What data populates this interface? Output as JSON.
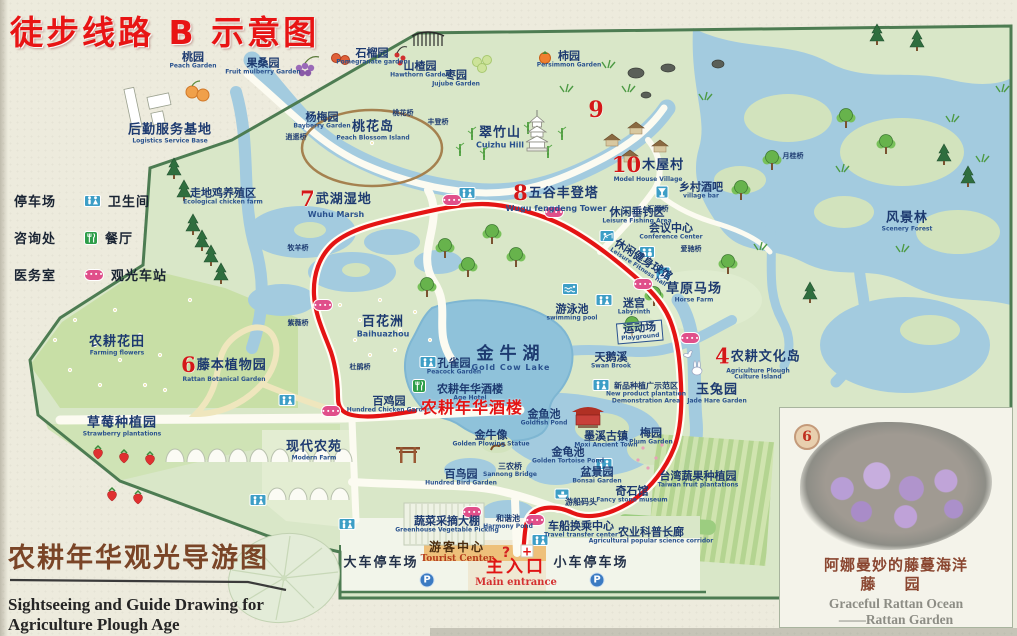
{
  "title": "徒步线路 B 示意图",
  "colors": {
    "route_red": "#e41414",
    "title_red": "#e81414",
    "water": "#a3cbdf",
    "land": "#d9e7c8",
    "label_blue": "#1d3a70",
    "badge_red": "#d41818",
    "footer_brown": "#7a4527",
    "toilet_icon": "#3d9ec6",
    "restaurant_icon": "#2e9e4a",
    "bus_station_icon": "#e04f8a"
  },
  "legend": {
    "left": [
      {
        "label": "停车场"
      },
      {
        "label": "咨询处"
      },
      {
        "label": "医务室"
      }
    ],
    "right": [
      {
        "label": "卫生间"
      },
      {
        "label": "餐厅"
      },
      {
        "label": "观光车站"
      }
    ]
  },
  "footer": {
    "zh": "农耕年华观光导游图",
    "en1": "Sightseeing and Guide Drawing for",
    "en2": "Agriculture Plough Age"
  },
  "inset": {
    "badge": "6",
    "zh1": "阿娜曼妙的藤蔓海洋",
    "zh2": "藤 园",
    "en1": "Graceful Rattan Ocean",
    "en2": "——Rattan Garden"
  },
  "map": {
    "badges": [
      {
        "n": "9",
        "x": 596,
        "y": 110
      }
    ],
    "labels": [
      {
        "name": "peach-garden",
        "zh": "桃园",
        "en": "Peach Garden",
        "x": 193,
        "y": 61
      },
      {
        "name": "fruit-mulberry-garden",
        "zh": "果桑园",
        "en": "Fruit mulberry Garden",
        "x": 263,
        "y": 67
      },
      {
        "name": "pomegranate-garden",
        "zh": "石榴园",
        "en": "Pomegranate garden",
        "x": 372,
        "y": 57
      },
      {
        "name": "hawthorn-garden",
        "zh": "山楂园",
        "en": "Hawthorn Garden",
        "x": 420,
        "y": 70
      },
      {
        "name": "jujube-garden",
        "zh": "枣园",
        "en": "Jujube Garden",
        "x": 456,
        "y": 79
      },
      {
        "name": "persimmon-garden",
        "zh": "柿园",
        "en": "Persimmon Garden",
        "x": 569,
        "y": 60
      },
      {
        "name": "bayberry-garden",
        "zh": "杨梅园",
        "en": "Bayberry Garden",
        "x": 322,
        "y": 121
      },
      {
        "name": "peach-blossom-island",
        "zh": "桃花岛",
        "en": "Peach Blossom Island",
        "x": 373,
        "y": 131,
        "cls": "lg"
      },
      {
        "name": "logistics-service-base",
        "zh": "后勤服务基地",
        "en": "Logistics Service Base",
        "x": 170,
        "y": 134,
        "cls": "lg"
      },
      {
        "name": "cuizhu-hill",
        "zh": "翠竹山",
        "en": "Cuizhu Hill",
        "x": 500,
        "y": 138,
        "cls": "lg en-lg"
      },
      {
        "name": "ecological-chicken-farm",
        "zh": "走地鸡养殖区",
        "en": "Ecological chicken farm",
        "x": 223,
        "y": 197
      },
      {
        "name": "wuhu-marsh",
        "num": "7",
        "zh": "武湖湿地",
        "en": "Wuhu Marsh",
        "x": 336,
        "y": 203,
        "cls": "lg en-lg"
      },
      {
        "name": "wugu-fengdeng-tower",
        "num": "8",
        "zh": "五谷丰登塔",
        "en": "Wugu fengdeng Tower",
        "x": 556,
        "y": 197,
        "cls": "lg en-lg"
      },
      {
        "name": "wooden-house-village",
        "num": "10",
        "zh": "木屋村",
        "en": "Model House Village",
        "x": 648,
        "y": 168,
        "cls": "lg"
      },
      {
        "name": "village-bar",
        "zh": "乡村酒吧",
        "en": "village bar",
        "x": 701,
        "y": 191
      },
      {
        "name": "leisure-fishing-area",
        "zh": "休闲垂钓区",
        "en": "Leisure Fishing Area",
        "x": 637,
        "y": 216
      },
      {
        "name": "conference-center",
        "zh": "会议中心",
        "en": "Conference Center",
        "x": 671,
        "y": 232
      },
      {
        "name": "scenery-forest",
        "zh": "风景林",
        "en": "Scenery Forest",
        "x": 907,
        "y": 222,
        "cls": "lg"
      },
      {
        "name": "horse-farm",
        "zh": "草原马场",
        "en": "Horse Farm",
        "x": 694,
        "y": 293,
        "cls": "lg"
      },
      {
        "name": "leisure-fitness-hall",
        "zh": "休闲健身球馆",
        "en": "Leisure Fitness hall",
        "x": 641,
        "y": 263,
        "cls": "rot"
      },
      {
        "name": "baihuazhou",
        "zh": "百花洲",
        "en": "Baihuazhou",
        "x": 383,
        "y": 327,
        "cls": "lg en-lg"
      },
      {
        "name": "swimming-pool",
        "zh": "游泳池",
        "en": "swimming pool",
        "x": 572,
        "y": 313
      },
      {
        "name": "labyrinth",
        "zh": "迷宫",
        "en": "Labyrinth",
        "x": 634,
        "y": 307
      },
      {
        "name": "playground",
        "zh": "运动场",
        "en": "Playground",
        "x": 640,
        "y": 332,
        "cls": "boxed"
      },
      {
        "name": "gold-cow-lake",
        "zh": "金牛湖",
        "en": "Gold Cow Lake",
        "x": 511,
        "y": 359,
        "cls": "xl"
      },
      {
        "name": "peacock-garden",
        "zh": "孔雀园",
        "en": "Peacock Garden",
        "x": 454,
        "y": 367
      },
      {
        "name": "swan-brook",
        "zh": "天鹅溪",
        "en": "Swan Brook",
        "x": 611,
        "y": 361
      },
      {
        "name": "farming-flowers",
        "zh": "农耕花田",
        "en": "Farming flowers",
        "x": 117,
        "y": 346,
        "cls": "lg"
      },
      {
        "name": "rattan-botanical-garden",
        "num": "6",
        "zh": "藤本植物园",
        "en": "Rattan Botanical Garden",
        "x": 224,
        "y": 368,
        "cls": "lg"
      },
      {
        "name": "agriculture-plough-culture-island",
        "num": "4",
        "zh": "农耕文化岛",
        "en": "Agriculture Plough Culture Island",
        "x": 758,
        "y": 363,
        "cls": "lg wrap"
      },
      {
        "name": "jade-hare-garden",
        "zh": "玉兔园",
        "en": "Jade Hare Garden",
        "x": 717,
        "y": 394,
        "cls": "lg"
      },
      {
        "name": "new-product-demo-area",
        "zh": "新品种植广示范区",
        "en": "New product plantation Demonstration Area",
        "x": 646,
        "y": 394,
        "cls": "sm wrap"
      },
      {
        "name": "moxi-ancient-town",
        "zh": "墨溪古镇",
        "en": "Moxi Ancient Town",
        "x": 606,
        "y": 440
      },
      {
        "name": "plum-garden",
        "zh": "梅园",
        "en": "Plum Garden",
        "x": 651,
        "y": 437
      },
      {
        "name": "hundred-chicken-garden",
        "zh": "百鸡园",
        "en": "Hundred Chicken Garden",
        "x": 389,
        "y": 405
      },
      {
        "name": "age-hotel",
        "zh": "农耕年华酒楼",
        "en": "Age Hotel",
        "x": 470,
        "y": 393
      },
      {
        "name": "age-hotel-red-note",
        "zh": "农耕年华酒楼",
        "x": 472,
        "y": 408,
        "cls": "red-note"
      },
      {
        "name": "goldfish-pond",
        "zh": "金鱼池",
        "en": "Goldfish Pond",
        "x": 544,
        "y": 418
      },
      {
        "name": "strawberry-plantations",
        "zh": "草莓种植园",
        "en": "Strawberry plantations",
        "x": 122,
        "y": 427,
        "cls": "lg"
      },
      {
        "name": "modern-farm",
        "zh": "现代农苑",
        "en": "Modern Farm",
        "x": 314,
        "y": 451,
        "cls": "lg"
      },
      {
        "name": "golden-ox-statue",
        "zh": "金牛像",
        "en": "Golden Plowing Statue",
        "x": 491,
        "y": 439
      },
      {
        "name": "golden-tortoise-pond",
        "zh": "金龟池",
        "en": "Golden Tortoise Pond",
        "x": 568,
        "y": 456
      },
      {
        "name": "hundred-bird-garden",
        "zh": "百鸟园",
        "en": "Hundred Bird Garden",
        "x": 461,
        "y": 478
      },
      {
        "name": "sannong-bridge",
        "zh": "三农桥",
        "en": "Sannong Bridge",
        "x": 510,
        "y": 471,
        "cls": "sm"
      },
      {
        "name": "bonsai-garden",
        "zh": "盆景园",
        "en": "Bonsai Garden",
        "x": 597,
        "y": 476
      },
      {
        "name": "fancy-stone-museum",
        "zh": "奇石馆",
        "en": "Fancy stone museum",
        "x": 632,
        "y": 495
      },
      {
        "name": "taiwan-fruit-plantations",
        "zh": "台湾蔬果种植园",
        "en": "Taiwan fruit plantations",
        "x": 698,
        "y": 480
      },
      {
        "name": "greenhouse-vegetable-picking",
        "zh": "蔬菜采摘大棚",
        "en": "Greenhouse Vegetable Picking",
        "x": 447,
        "y": 525
      },
      {
        "name": "harmony-pond",
        "zh": "和谐池",
        "en": "Harmony Pond",
        "x": 508,
        "y": 523,
        "cls": "sm"
      },
      {
        "name": "travel-transfer-center",
        "zh": "车船换乘中心",
        "en": "Travel transfer center",
        "x": 581,
        "y": 530
      },
      {
        "name": "agri-science-corridor",
        "zh": "农业科普长廊",
        "en": "Agricultural popular science corridor",
        "x": 651,
        "y": 536
      },
      {
        "name": "boat-dock",
        "zh": "游船码头",
        "x": 581,
        "y": 503,
        "cls": "sm"
      },
      {
        "name": "tourist-center",
        "zh": "游客中心",
        "en": "Tourist Center",
        "x": 457,
        "y": 553,
        "cls": "tourist"
      },
      {
        "name": "main-entrance",
        "zh": "主入口",
        "en": "Main entrance",
        "x": 516,
        "y": 573,
        "cls": "entrance"
      },
      {
        "name": "large-vehicle-parking",
        "zh": "大车停车场",
        "x": 381,
        "y": 564,
        "cls": "parking-label"
      },
      {
        "name": "small-car-parking",
        "zh": "小车停车场",
        "x": 591,
        "y": 564,
        "cls": "parking-label"
      },
      {
        "name": "xiaoyao-bridge",
        "zh": "逍遥桥",
        "x": 296,
        "y": 138,
        "cls": "bridge"
      },
      {
        "name": "taohua-bridge",
        "zh": "桃花桥",
        "x": 403,
        "y": 114,
        "cls": "bridge"
      },
      {
        "name": "fengdeng-bridge",
        "zh": "丰登桥",
        "x": 438,
        "y": 123,
        "cls": "bridge"
      },
      {
        "name": "muyang-bridge",
        "zh": "牧羊桥",
        "x": 298,
        "y": 249,
        "cls": "bridge"
      },
      {
        "name": "ziwei-bridge",
        "zh": "紫薇桥",
        "x": 298,
        "y": 324,
        "cls": "bridge"
      },
      {
        "name": "dujuan-bridge",
        "zh": "杜鹃桥",
        "x": 360,
        "y": 368,
        "cls": "bridge"
      },
      {
        "name": "huiyuan-bridge",
        "zh": "汇源桥",
        "x": 658,
        "y": 210,
        "cls": "bridge"
      },
      {
        "name": "yuegui-bridge",
        "zh": "月桂桥",
        "x": 793,
        "y": 157,
        "cls": "bridge"
      },
      {
        "name": "aichi-bridge",
        "zh": "爱驰桥",
        "x": 691,
        "y": 250,
        "cls": "bridge"
      }
    ],
    "icons": [
      {
        "t": "wc",
        "x": 467,
        "y": 193
      },
      {
        "t": "wc",
        "x": 604,
        "y": 300
      },
      {
        "t": "wc",
        "x": 428,
        "y": 362
      },
      {
        "t": "wc",
        "x": 601,
        "y": 385
      },
      {
        "t": "wc",
        "x": 287,
        "y": 400
      },
      {
        "t": "wc",
        "x": 347,
        "y": 524
      },
      {
        "t": "wc",
        "x": 540,
        "y": 540
      },
      {
        "t": "wc",
        "x": 258,
        "y": 500
      },
      {
        "t": "wc",
        "x": 604,
        "y": 464
      },
      {
        "t": "restaurant",
        "x": 419,
        "y": 386
      },
      {
        "t": "bus",
        "x": 452,
        "y": 200
      },
      {
        "t": "bus",
        "x": 554,
        "y": 212
      },
      {
        "t": "bus",
        "x": 323,
        "y": 305
      },
      {
        "t": "bus",
        "x": 643,
        "y": 284
      },
      {
        "t": "bus",
        "x": 690,
        "y": 338
      },
      {
        "t": "bus",
        "x": 331,
        "y": 411
      },
      {
        "t": "bus",
        "x": 472,
        "y": 512
      },
      {
        "t": "bus",
        "x": 535,
        "y": 520
      },
      {
        "t": "pool",
        "x": 570,
        "y": 289
      },
      {
        "t": "horse",
        "x": 663,
        "y": 273
      },
      {
        "t": "bar",
        "x": 662,
        "y": 192
      },
      {
        "t": "meeting",
        "x": 647,
        "y": 252
      },
      {
        "t": "fishing",
        "x": 607,
        "y": 236
      },
      {
        "t": "boat",
        "x": 562,
        "y": 494
      },
      {
        "t": "parking",
        "x": 427,
        "y": 580
      },
      {
        "t": "parking",
        "x": 597,
        "y": 580
      },
      {
        "t": "question",
        "x": 506,
        "y": 553
      },
      {
        "t": "cross",
        "x": 527,
        "y": 551
      }
    ]
  }
}
